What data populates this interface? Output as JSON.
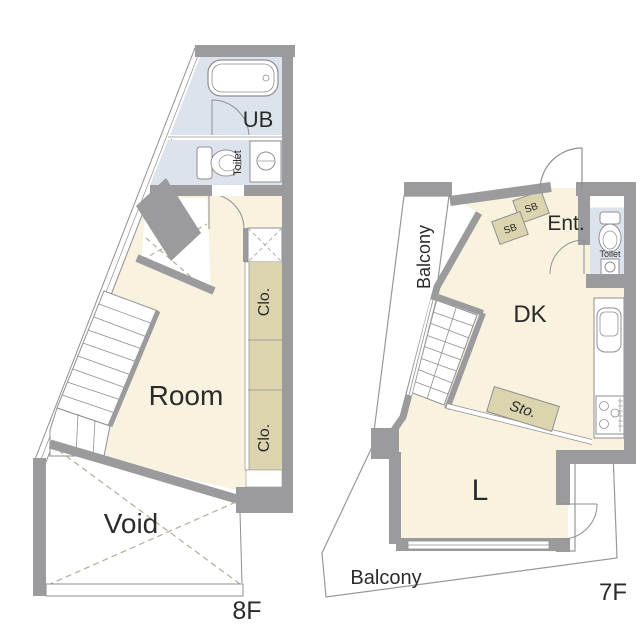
{
  "colors": {
    "background": "#ffffff",
    "room_fill": "#f8f2df",
    "closet_fill": "#dcd4ae",
    "bath_fill": "#dde3ed",
    "wall_gray": "#9b9b9d",
    "outline_gray": "#8f8f91",
    "dash_tan": "#b6ab96",
    "text": "#2b2b2b"
  },
  "floor_8f": {
    "floor_label": "8F",
    "unit_bath_label": "UB",
    "toilet_label": "Toilet",
    "closet_upper_label": "Clo.",
    "closet_lower_label": "Clo.",
    "room_label": "Room",
    "void_label": "Void"
  },
  "floor_7f": {
    "floor_label": "7F",
    "balcony_left_label": "Balcony",
    "entrance_label": "Ent.",
    "shoe_box_1_label": "SB",
    "shoe_box_2_label": "SB",
    "toilet_label": "Toilet",
    "dining_kitchen_label": "DK",
    "storage_label": "Sto.",
    "living_label": "L",
    "balcony_bottom_label": "Balcony"
  }
}
